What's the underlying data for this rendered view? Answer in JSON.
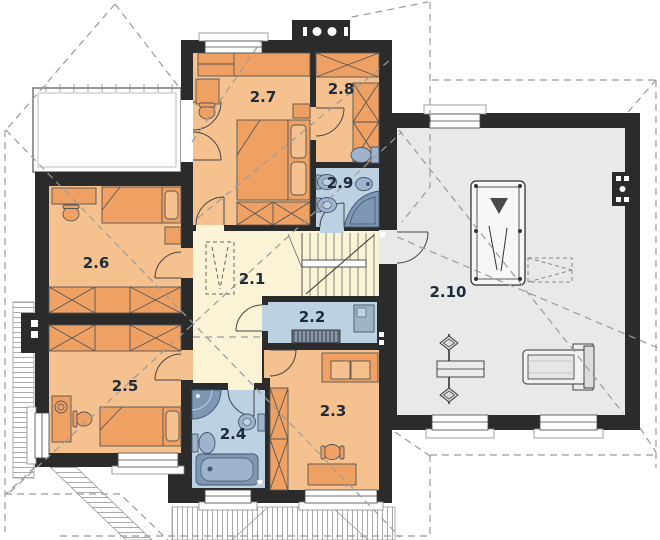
{
  "plan": {
    "kind": "upper-floor-plan",
    "rooms": [
      {
        "label": "2.1",
        "furniture": [
          "stairs",
          "planned-wardrobe"
        ]
      },
      {
        "label": "2.2",
        "furniture": [
          "desk",
          "radiator"
        ]
      },
      {
        "label": "2.3",
        "furniture": [
          "sofa",
          "wardrobe",
          "desk",
          "chair"
        ]
      },
      {
        "label": "2.4",
        "furniture": [
          "shower",
          "toilet",
          "washbasin",
          "bathtub"
        ]
      },
      {
        "label": "2.5",
        "furniture": [
          "wardrobe",
          "desk",
          "chair",
          "bed",
          "plant"
        ]
      },
      {
        "label": "2.6",
        "furniture": [
          "desk",
          "chair",
          "bed",
          "nightstand",
          "wardrobe"
        ]
      },
      {
        "label": "2.7",
        "furniture": [
          "wardrobe",
          "desk",
          "chair",
          "double-bed",
          "nightstand",
          "wardrobe"
        ]
      },
      {
        "label": "2.8",
        "furniture": [
          "wardrobe",
          "wardrobe"
        ]
      },
      {
        "label": "2.9",
        "furniture": [
          "washbasin",
          "washbasin",
          "toilet",
          "bidet",
          "corner-bathtub"
        ]
      },
      {
        "label": "2.10",
        "furniture": [
          "billiard-table",
          "bench-press",
          "treadmill"
        ]
      }
    ],
    "colors": {
      "wall": "#2b2b2b",
      "bedroom_floor": "#f5c28f",
      "furniture_orange": "#efa163",
      "hall_floor": "#fbf3d6",
      "bathroom_floor": "#bcd2e3",
      "fixture_blue": "#9fb4cc",
      "fixture_blue_dark": "#7e98b3",
      "recreation_floor": "#e8eaea",
      "roof_dash": "#9b9b9b",
      "label_text": "#1d2b3a"
    }
  }
}
